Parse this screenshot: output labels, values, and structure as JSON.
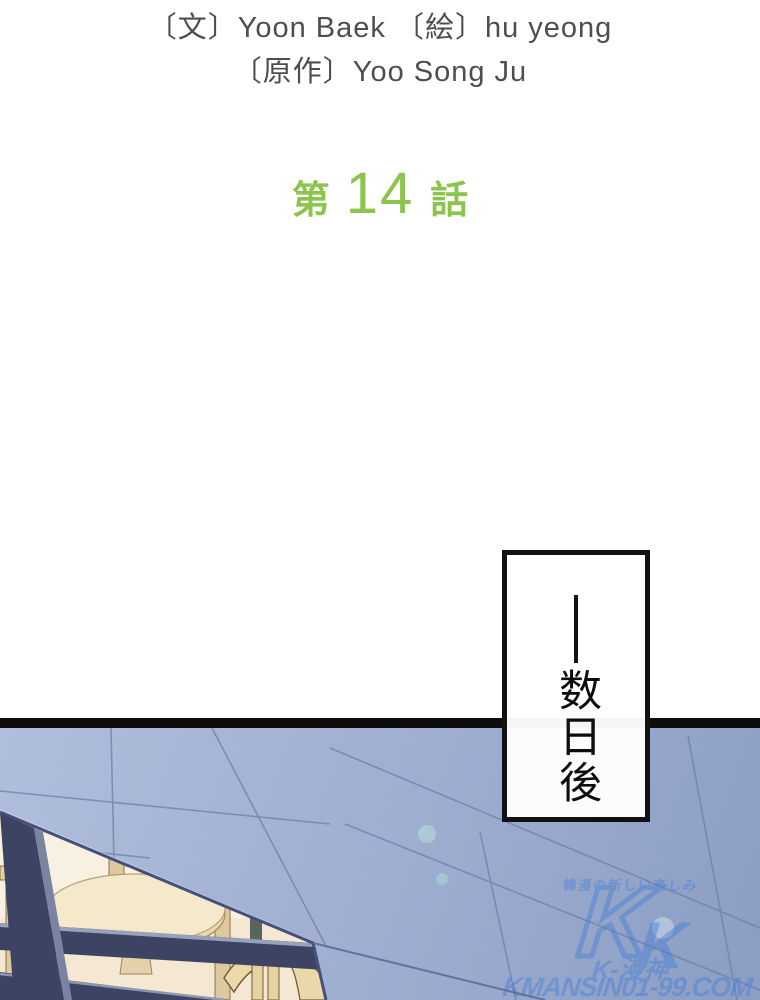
{
  "credits": {
    "line1": "〔文〕Yoon Baek 〔絵〕hu yeong",
    "line2": "〔原作〕Yoo Song Ju",
    "color": "#4e4e4e"
  },
  "chapter": {
    "prefix": "第",
    "number": "14",
    "suffix": "話",
    "color": "#8cc44e"
  },
  "caption": {
    "dash": "──",
    "text": "数日後"
  },
  "panel": {
    "border_color": "#0c0c0c",
    "colors": {
      "wall_light": "#b0bedc",
      "wall_dark": "#8b9dc3",
      "wall_seam": "#6e7fa9",
      "wall_edge": "#46507a",
      "frame": "#3d4463",
      "frame_bevel": "#99a1ba",
      "interior": "#f8f1e2",
      "floor": "#f2e6d0",
      "table": "#f5e9cc",
      "wood": "#ecd9a9",
      "wood_outline": "#6f5c38",
      "teal_accent": "#57655d"
    },
    "watermark": {
      "tagline": "韓漫の新しい楽しみ",
      "logo_letter": "K",
      "brand": "K-漫神",
      "domain": "KMANSIN01-99.COM",
      "color": "#3f7cd6"
    }
  }
}
